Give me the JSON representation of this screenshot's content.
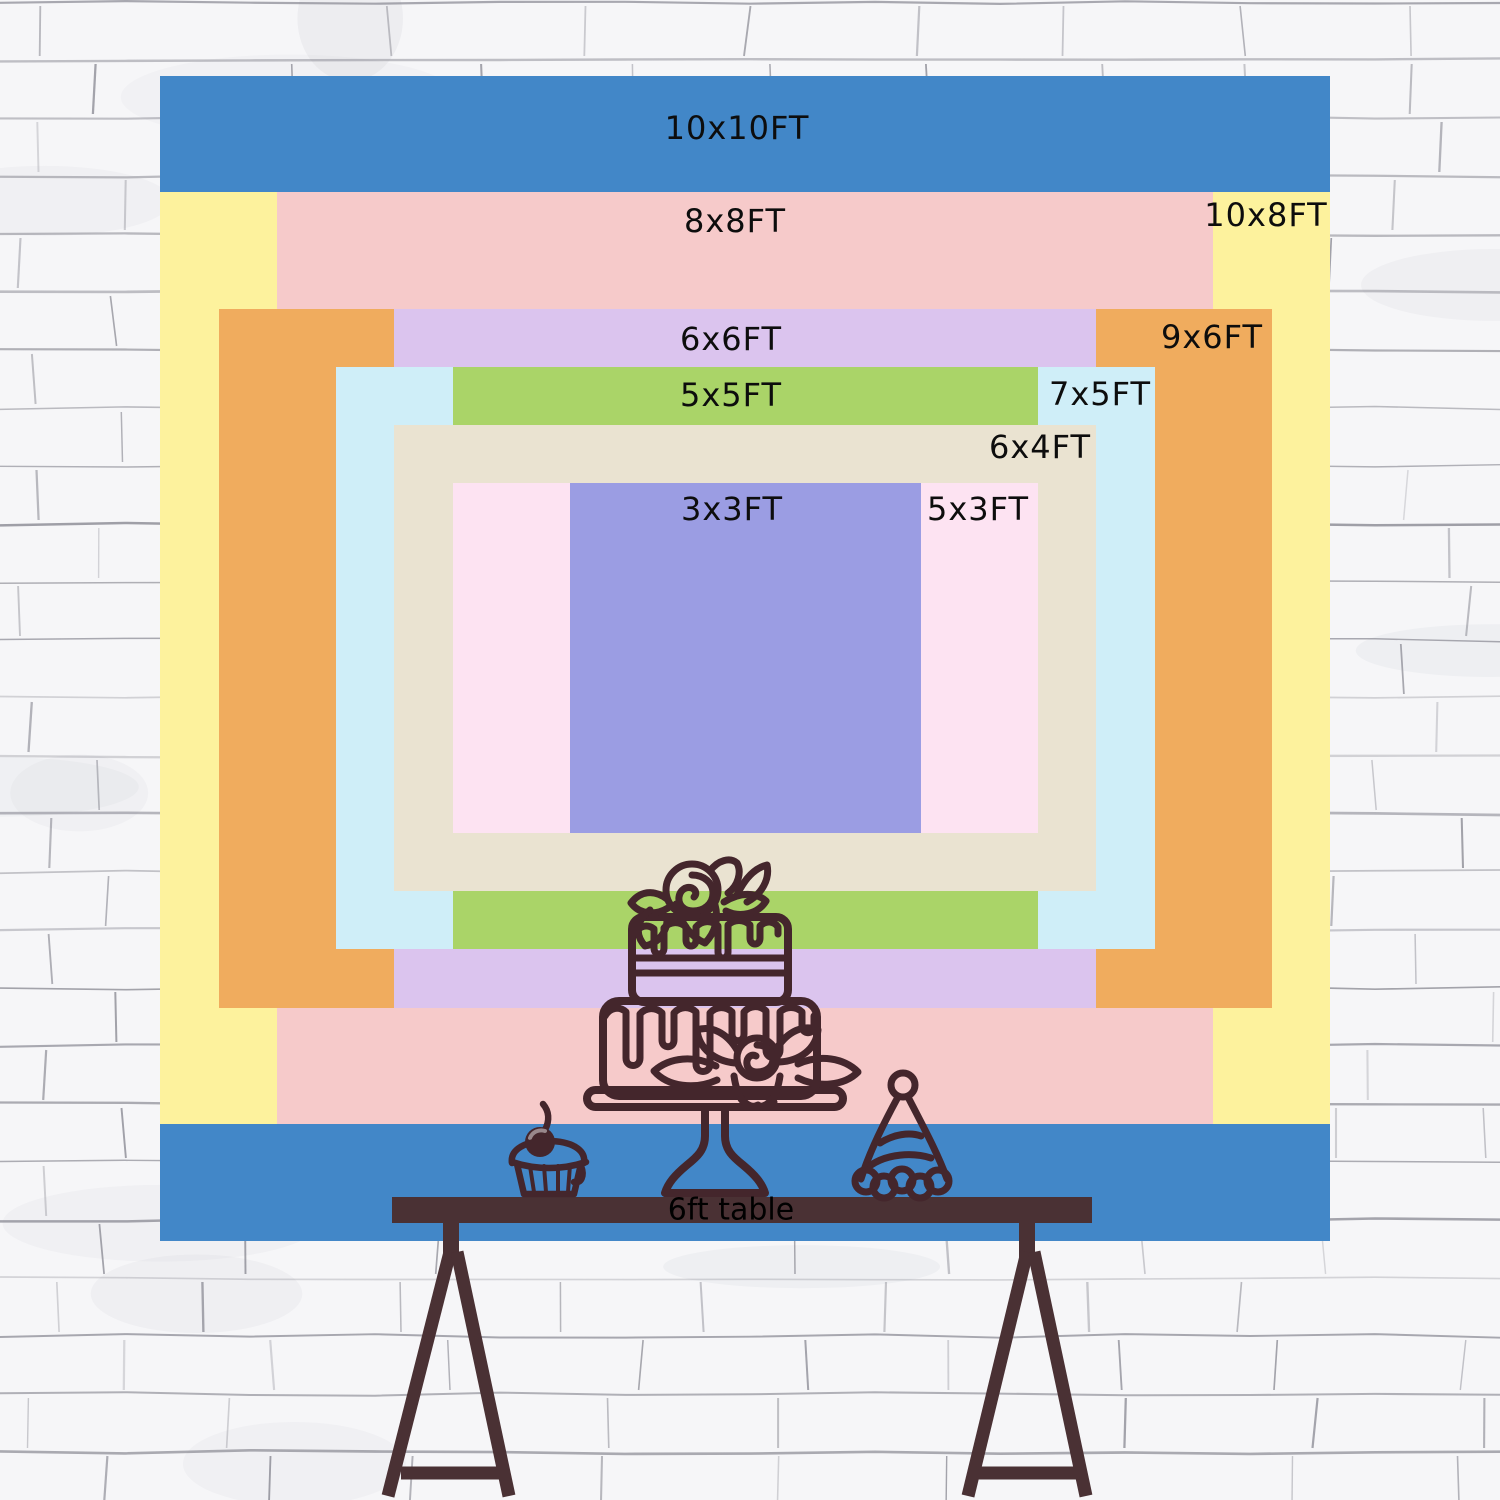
{
  "chart_data": {
    "type": "nested-size-comparison",
    "unit": "FT",
    "center_px": {
      "x": 745,
      "y": 658,
      "px_per_ft_x": 117,
      "px_per_ft_y": 116.5
    },
    "backdrops": [
      {
        "label": "10x10FT",
        "width_ft": 10,
        "height_ft": 10,
        "color": "#4287c8",
        "label_x": 737,
        "label_y": 128
      },
      {
        "label": "10x8FT",
        "width_ft": 10,
        "height_ft": 8,
        "color": "#fdf29d",
        "label_x": 1266,
        "label_y": 215
      },
      {
        "label": "8x8FT",
        "width_ft": 8,
        "height_ft": 8,
        "color": "#f6caca",
        "label_x": 735,
        "label_y": 221
      },
      {
        "label": "9x6FT",
        "width_ft": 9,
        "height_ft": 6,
        "color": "#f0ac5e",
        "label_x": 1212,
        "label_y": 337
      },
      {
        "label": "6x6FT",
        "width_ft": 6,
        "height_ft": 6,
        "color": "#dbc4ee",
        "label_x": 731,
        "label_y": 339
      },
      {
        "label": "7x5FT",
        "width_ft": 7,
        "height_ft": 5,
        "color": "#cfeef8",
        "label_x": 1100,
        "label_y": 394
      },
      {
        "label": "5x5FT",
        "width_ft": 5,
        "height_ft": 5,
        "color": "#aad468",
        "label_x": 731,
        "label_y": 395
      },
      {
        "label": "6x4FT",
        "width_ft": 6,
        "height_ft": 4,
        "color": "#eae3d1",
        "label_x": 1040,
        "label_y": 447
      },
      {
        "label": "5x3FT",
        "width_ft": 5,
        "height_ft": 3,
        "color": "#fde3f2",
        "label_x": 978,
        "label_y": 509
      },
      {
        "label": "3x3FT",
        "width_ft": 3,
        "height_ft": 3,
        "color": "#9b9de3",
        "label_x": 732,
        "label_y": 509
      }
    ],
    "table": {
      "label": "6ft table",
      "width_ft": 6
    }
  },
  "palette": {
    "wall_base": "#f6f6f8",
    "mortar": "#82828c",
    "line_art": "#44262c",
    "table_brown": "#4a3134",
    "label_text": "#0d0d0d"
  },
  "decorations": [
    "tiered-cake",
    "cupcake",
    "party-hat",
    "trestle-table"
  ]
}
